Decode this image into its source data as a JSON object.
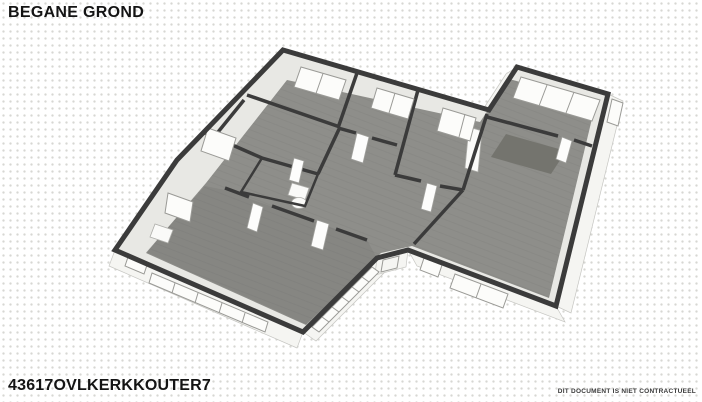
{
  "page": {
    "title": "BEGANE GROND",
    "reference": "43617OVLKERKKOUTER7",
    "disclaimer": "DIT DOCUMENT IS NIET CONTRACTUEEL"
  },
  "plan": {
    "label": "3d-floor-plan-ground-floor",
    "colors": {
      "background": "#ffffff",
      "dotGrid": "#d7d7d3",
      "wall": "#3b3b3b",
      "floor": "#8e8e8a",
      "innerFace": "#e8e8e4",
      "outerFace": "#f5f5f2",
      "outerFaceEdge": "#c6c6c2",
      "window": "#fcfcfa",
      "windowFrame": "#9a9a96",
      "rug": "#73736d"
    }
  }
}
